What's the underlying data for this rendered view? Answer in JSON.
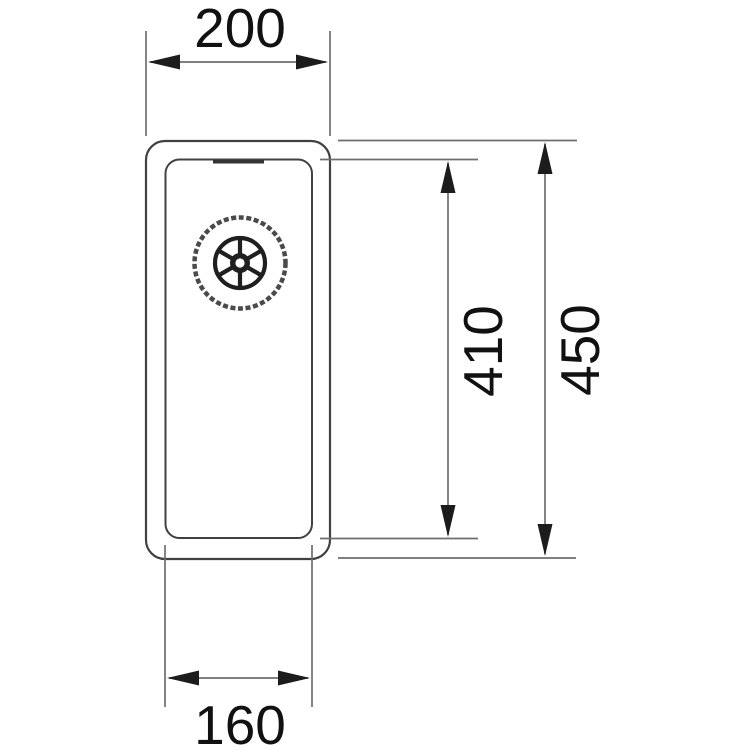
{
  "drawing": {
    "title": "sink-technical-drawing",
    "dimensions": {
      "outer_width": "200",
      "inner_width": "160",
      "inner_depth": "410",
      "outer_depth": "450"
    },
    "colors": {
      "outline": "#414141",
      "dimension_line": "#6e6e6e",
      "arrow": "#1c1c1c",
      "text": "#111111",
      "background": "#ffffff"
    }
  }
}
